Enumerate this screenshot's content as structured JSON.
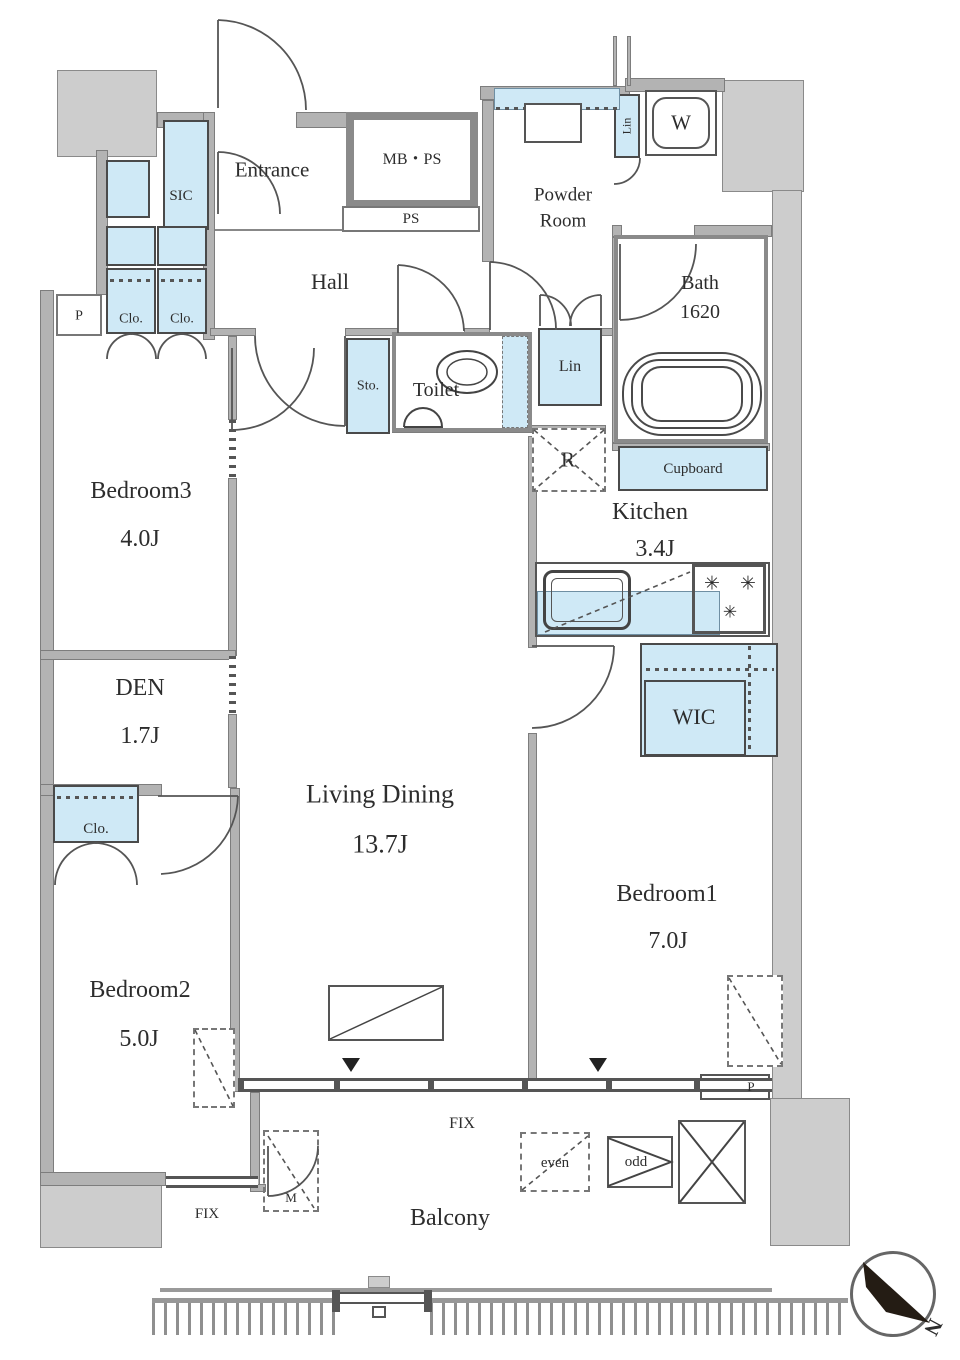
{
  "rooms": {
    "entrance": {
      "label": "Entrance"
    },
    "hall": {
      "label": "Hall"
    },
    "powder_room": {
      "line1": "Powder",
      "line2": "Room"
    },
    "bath": {
      "label": "Bath",
      "size": "1620"
    },
    "toilet": {
      "label": "Toilet"
    },
    "kitchen": {
      "label": "Kitchen",
      "size": "3.4J"
    },
    "living_dining": {
      "label": "Living Dining",
      "size": "13.7J"
    },
    "bedroom1": {
      "label": "Bedroom1",
      "size": "7.0J"
    },
    "bedroom2": {
      "label": "Bedroom2",
      "size": "5.0J"
    },
    "bedroom3": {
      "label": "Bedroom3",
      "size": "4.0J"
    },
    "den": {
      "label": "DEN",
      "size": "1.7J"
    },
    "wic": {
      "label": "WIC"
    },
    "balcony": {
      "label": "Balcony"
    }
  },
  "fixtures": {
    "sic": "SIC",
    "sto": "Sto.",
    "lin_upper": "Lin",
    "lin_lower": "Lin",
    "cupboard": "Cupboard",
    "clo_a": "Clo.",
    "clo_b": "Clo.",
    "clo_bedroom2": "Clo.",
    "mb_ps": "MB・PS",
    "ps": "PS",
    "washer": "W",
    "fridge": "R",
    "meter": "M",
    "hatch_even": "even",
    "hatch_odd": "odd",
    "pipe_left": "P",
    "pipe_right": "P",
    "fix_main": "FIX",
    "fix_side": "FIX"
  },
  "compass": {
    "north_label": "N"
  },
  "colors": {
    "storage_blue": "#cfe9f6",
    "wall_gray": "#b3b3b3",
    "common_gray": "#cdcdcd",
    "line_dark": "#4a4a4a"
  }
}
